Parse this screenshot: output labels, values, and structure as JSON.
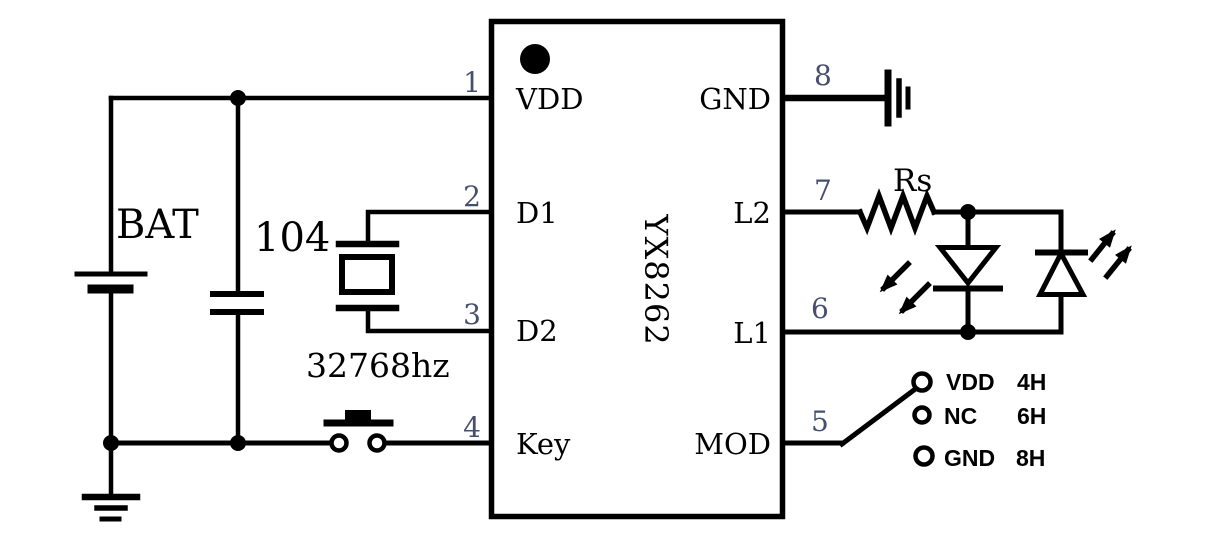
{
  "ic": {
    "part": "YX8262",
    "left_pins": [
      {
        "number": "1",
        "name": "VDD"
      },
      {
        "number": "2",
        "name": "D1"
      },
      {
        "number": "3",
        "name": "D2"
      },
      {
        "number": "4",
        "name": "Key"
      }
    ],
    "right_pins": [
      {
        "number": "8",
        "name": "GND"
      },
      {
        "number": "7",
        "name": "L2"
      },
      {
        "number": "6",
        "name": "L1"
      },
      {
        "number": "5",
        "name": "MOD"
      }
    ]
  },
  "components": {
    "battery_label": "BAT",
    "capacitor_label": "104",
    "crystal_label": "32768hz",
    "resistor_label": "Rs"
  },
  "mod_options": [
    {
      "option": "VDD",
      "mode": "4H"
    },
    {
      "option": "NC",
      "mode": "6H"
    },
    {
      "option": "GND",
      "mode": "8H"
    }
  ],
  "colors": {
    "wire": "#000000",
    "pin_number": "#46506e",
    "background": "#ffffff"
  }
}
